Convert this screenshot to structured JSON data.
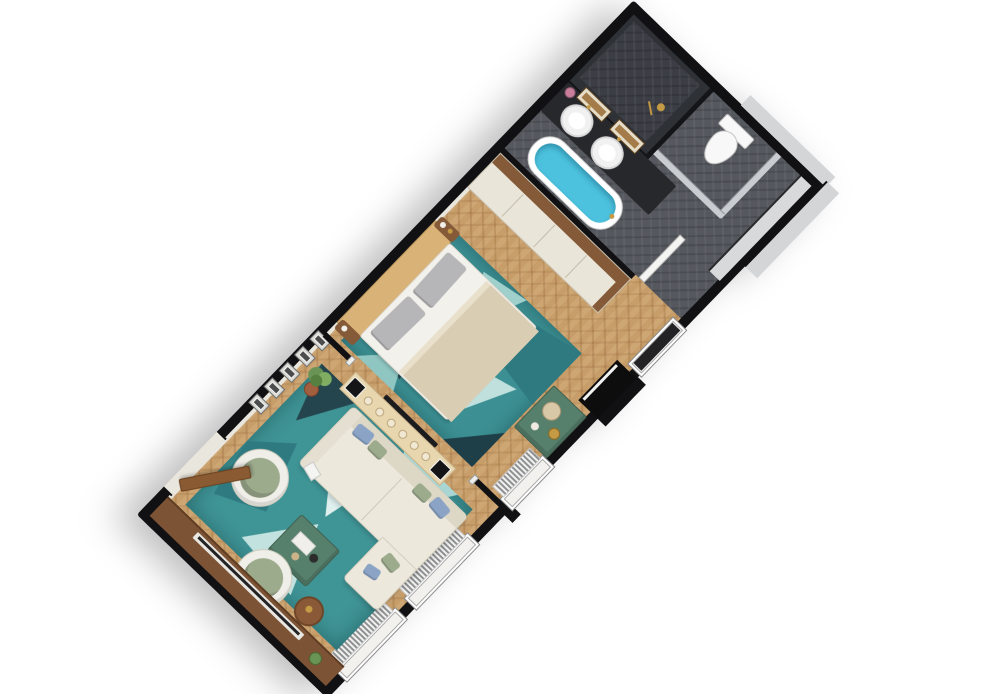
{
  "meta": {
    "scene": "3d-floorplan-render",
    "view": "rotated isometric top-down",
    "description": "long rectangular hotel suite floor plan rotated diagonally on white background, bathroom at top-right, bedroom in middle, living room at bottom-left"
  },
  "palette": {
    "page-bg": "#ffffff",
    "wall": "#111113",
    "wall-face": "#e9e6dd",
    "wall-gray": "#d3d5d7",
    "parquet": "#c79e6a",
    "tile": "#55585e",
    "tile-dark": "#3b3e44",
    "shower-wall": "#2e3136",
    "cream": "#eae5d9",
    "walnut": "#845a38",
    "walnut-deep": "#6e4527",
    "wood-light": "#d8b277",
    "mattress": "#f3f1ec",
    "blanket": "#d9cdb4",
    "pillow": "#b6b6b8",
    "water": "#4cc2de",
    "marble-green": "#567f6c",
    "sage": "#9dab8d",
    "blue": "#8ba4c6",
    "gold": "#c49a44",
    "rug": "#3c9093",
    "rug-dark": "#24454e",
    "rug-mid": "#2f7a80",
    "rug-pale": "#b7dcda",
    "toilet": "#f8f8f8",
    "counter": "#26282c",
    "door-brown": "#8a5a33",
    "frame-white": "#f2f1ee"
  },
  "rooms": [
    {
      "id": "bathroom",
      "floor": "dark-gray-herringbone-tile",
      "fixtures": [
        "walk-in-shower-dark-walls",
        "gold-shower-head",
        "toilet-in-stall",
        "double-vanity-dark-counter",
        "two-white-vessel-sinks",
        "two-wood-framed-mirrors",
        "pink-flower-vase",
        "freestanding-oval-bathtub-teal-water",
        "white-door-leaf",
        "dark-glass-door"
      ]
    },
    {
      "id": "bedroom",
      "floor": "oak-herringbone-parquet",
      "furniture": [
        "double-bed-white-and-beige-linens",
        "gray-pillows",
        "curved-light-wood-headboard",
        "two-nightstand-caps-with-decor",
        "teal-geometric-rug",
        "cream-credenza-walnut-top",
        "green-marble-console",
        "beige-ceramic-jug",
        "gold-vase",
        "dark-wall-niche"
      ]
    },
    {
      "id": "living-room",
      "floor": "oak-herringbone-parquet",
      "furniture": [
        "cream-l-shaped-sofa",
        "blue-and-sage-pillows",
        "console-table-with-candlesticks",
        "two-black-square-lamps",
        "green-marble-coffee-table",
        "two-white-swivel-armchairs-sage-cushions",
        "round-walnut-side-table",
        "potted-plant",
        "walnut-tv-sideboard",
        "tv-panel",
        "teal-geometric-rug",
        "gallery-wall-five-frames",
        "open-entry-door-brown"
      ]
    }
  ],
  "counts": {
    "se-wall-windows": 3,
    "picture-frames": 5,
    "candlesticks": 6,
    "sinks": 2,
    "mirrors": 2,
    "swivel-armchairs": 2,
    "rugs": 2,
    "lamps": 2
  }
}
